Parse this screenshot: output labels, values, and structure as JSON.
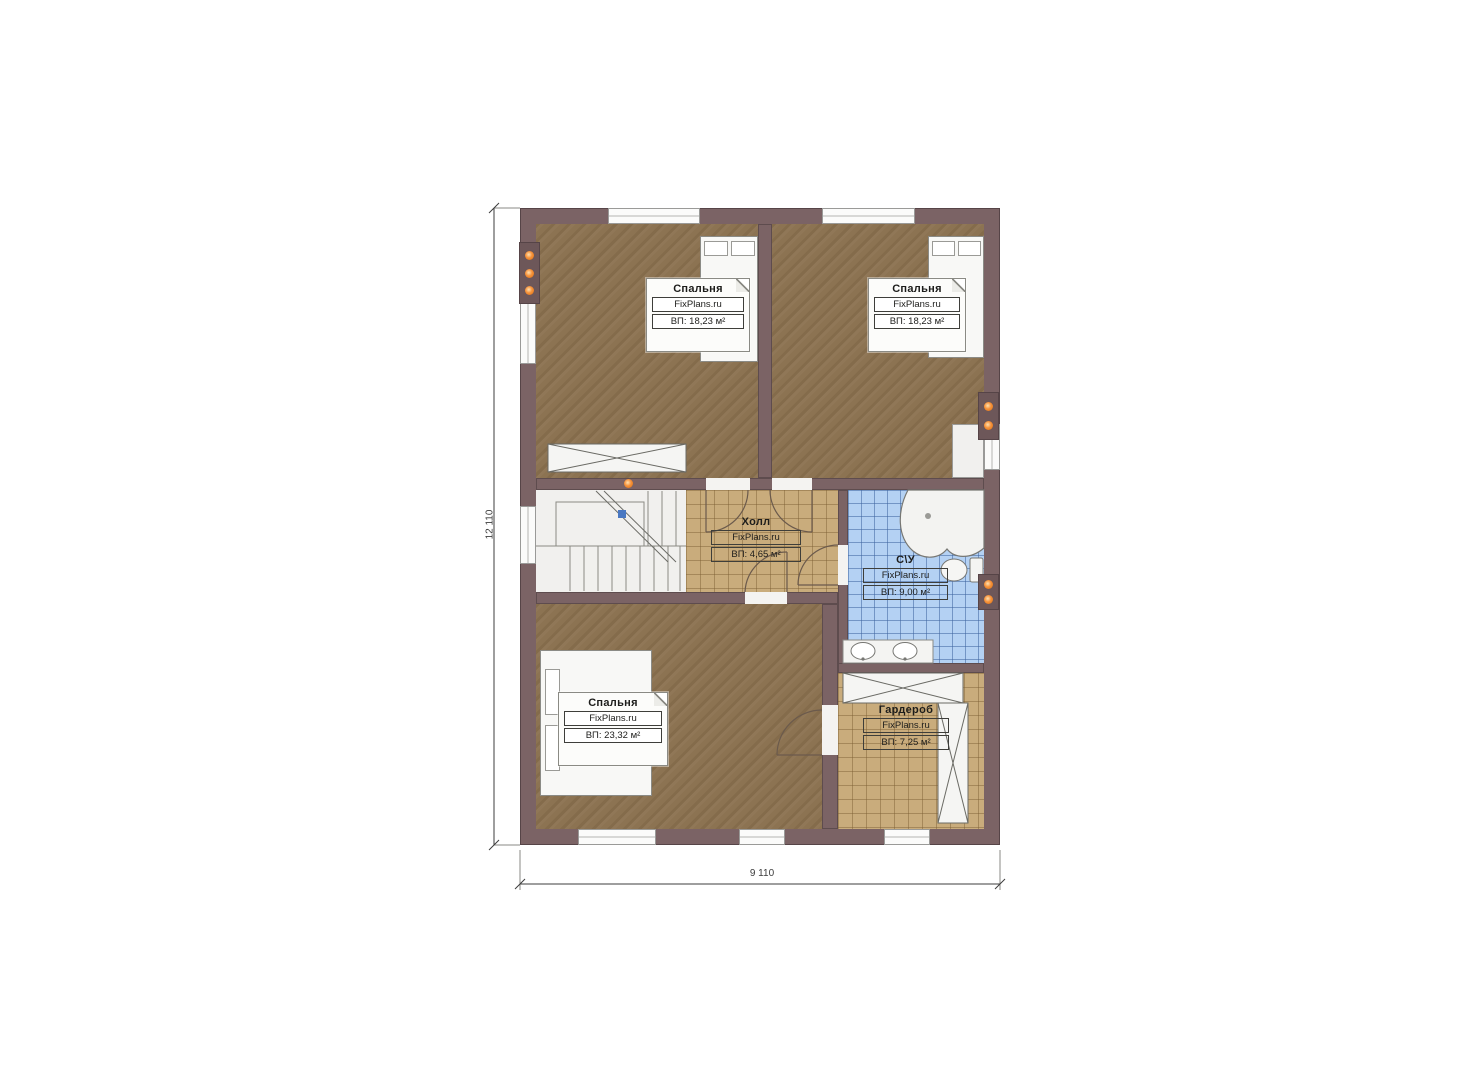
{
  "plan": {
    "type": "floor-plan",
    "brand": "FixPlans.ru",
    "rooms": [
      {
        "name": "Спальня",
        "brand": "FixPlans.ru",
        "area": "ВП: 18,23 м²"
      },
      {
        "name": "Спальня",
        "brand": "FixPlans.ru",
        "area": "ВП: 18,23 м²"
      },
      {
        "name": "Холл",
        "brand": "FixPlans.ru",
        "area": "ВП: 4,65 м²"
      },
      {
        "name": "С\\У",
        "brand": "FixPlans.ru",
        "area": "ВП: 9,00 м²"
      },
      {
        "name": "Спальня",
        "brand": "FixPlans.ru",
        "area": "ВП: 23,32 м²"
      },
      {
        "name": "Гардероб",
        "brand": "FixPlans.ru",
        "area": "ВП: 7,25 м²"
      }
    ],
    "dimensions": {
      "height": "12 110",
      "width": "9 110"
    },
    "colors": {
      "wall": "#7b6365",
      "carpet": "#8c7352",
      "tile_tan": "#c9ac7c",
      "tile_blue": "#b4d1f3",
      "radiator_dot": "#ef8a2f"
    }
  }
}
